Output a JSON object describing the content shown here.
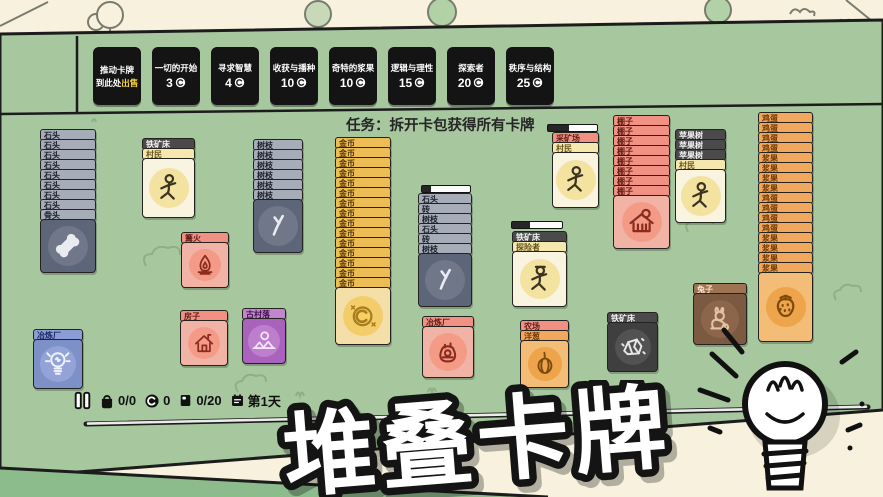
{
  "title_banner": {
    "text": "堆叠卡牌"
  },
  "task": {
    "label": "任务：拆开卡包获得所有卡牌"
  },
  "top_buttons": [
    {
      "line1": "推动卡牌",
      "line2_prefix": "到此处",
      "line2_highlight": "出售"
    },
    {
      "title": "一切的开始",
      "cost": "3"
    },
    {
      "title": "寻求智慧",
      "cost": "4"
    },
    {
      "title": "收获与播种",
      "cost": "10"
    },
    {
      "title": "奇特的浆果",
      "cost": "10"
    },
    {
      "title": "逻辑与理性",
      "cost": "15"
    },
    {
      "title": "探索者",
      "cost": "20"
    },
    {
      "title": "秩序与结构",
      "cost": "25"
    }
  ],
  "status_bar": {
    "pause_icon": "pause-icon",
    "bag_icon": "bag-icon",
    "bag_count": "0/0",
    "coin_icon": "coin-icon",
    "coin_count": "0",
    "card_icon": "cardpack-icon",
    "card_count": "0/20",
    "calendar_icon": "calendar-icon",
    "day_label": "第1天"
  },
  "colors": {
    "board_green": "#a7c79f",
    "paper_cream": "#f7f1dd",
    "button_black": "#141414",
    "sell_highlight": "#f6d335",
    "timeline_silver": "#ececec",
    "bottom_band_green": "#8cbc8c"
  },
  "board": {
    "stacks": [
      {
        "name": "stone-bone-stack",
        "x": 40,
        "y": 131,
        "w": 56,
        "bh": 54,
        "bars": [
          [
            "石头",
            "stone",
            8
          ],
          [
            "骨头",
            "stone",
            1
          ]
        ],
        "body": {
          "style": "stone",
          "icon": "bone-icon"
        }
      },
      {
        "name": "ironore-villager-stack",
        "x": 142,
        "y": 140,
        "w": 53,
        "bh": 60,
        "bars": [
          [
            "铁矿床",
            "dark",
            1
          ],
          [
            "村民",
            "cream",
            1
          ]
        ],
        "body": {
          "style": "cream",
          "icon": "villager-icon"
        }
      },
      {
        "name": "campfire-card",
        "x": 181,
        "y": 234,
        "w": 48,
        "bh": 46,
        "bars": [
          [
            "篝火",
            "salmon",
            1
          ]
        ],
        "body": {
          "style": "salmon",
          "icon": "flame-icon"
        }
      },
      {
        "name": "stick-stack",
        "x": 253,
        "y": 141,
        "w": 50,
        "bh": 54,
        "bars": [
          [
            "树枝",
            "stone",
            6
          ]
        ],
        "body": {
          "style": "stone",
          "icon": "stick-icon"
        }
      },
      {
        "name": "house-card",
        "x": 180,
        "y": 312,
        "w": 48,
        "bh": 46,
        "bars": [
          [
            "房子",
            "salmon",
            1
          ]
        ],
        "body": {
          "style": "salmon",
          "icon": "house-icon"
        }
      },
      {
        "name": "village-card",
        "x": 242,
        "y": 310,
        "w": 44,
        "bh": 46,
        "bars": [
          [
            "古村落",
            "purple",
            1
          ]
        ],
        "body": {
          "style": "purple",
          "icon": "village-icon"
        }
      },
      {
        "name": "coin-stack",
        "x": 335,
        "y": 139,
        "w": 56,
        "bh": 58,
        "bars": [
          [
            "金币",
            "gold",
            15
          ]
        ],
        "body": {
          "style": "gold",
          "icon": "coin-icon"
        }
      },
      {
        "name": "stone-brick-stick-stack",
        "x": 418,
        "y": 195,
        "w": 54,
        "bh": 54,
        "bars": [
          [
            "石头",
            "stone",
            1
          ],
          [
            "砖",
            "stone",
            1
          ],
          [
            "树枝",
            "stone",
            1
          ],
          [
            "石头",
            "stone",
            1
          ],
          [
            "砖",
            "stone",
            1
          ],
          [
            "树枝",
            "stone",
            1
          ]
        ],
        "body": {
          "style": "stone",
          "icon": "stick-icon"
        }
      },
      {
        "name": "smelter-card",
        "x": 422,
        "y": 318,
        "w": 52,
        "bh": 52,
        "bars": [
          [
            "冶炼厂",
            "salmon",
            1
          ]
        ],
        "body": {
          "style": "salmon",
          "icon": "furnace-icon"
        }
      },
      {
        "name": "ironore-explorer-stack",
        "x": 512,
        "y": 233,
        "w": 55,
        "bh": 56,
        "bars": [
          [
            "铁矿床",
            "dark",
            1
          ],
          [
            "探险者",
            "cream",
            1
          ]
        ],
        "body": {
          "style": "cream",
          "icon": "explorer-icon"
        }
      },
      {
        "name": "farm-onion-stack",
        "x": 520,
        "y": 322,
        "w": 49,
        "bh": 48,
        "bars": [
          [
            "农场",
            "salmon",
            1
          ],
          [
            "洋葱",
            "orange",
            1
          ]
        ],
        "body": {
          "style": "orange",
          "icon": "onion-icon"
        }
      },
      {
        "name": "idea-smelter-card",
        "x": 33,
        "y": 331,
        "w": 50,
        "bh": 50,
        "bars": [
          [
            "冶炼厂",
            "blue",
            1
          ]
        ],
        "body": {
          "style": "blue",
          "icon": "lightbulb-icon"
        }
      },
      {
        "name": "mine-villager-stack",
        "x": 552,
        "y": 134,
        "w": 47,
        "bh": 56,
        "bars": [
          [
            "采矿场",
            "salmon",
            1
          ],
          [
            "村民",
            "cream",
            1
          ]
        ],
        "body": {
          "style": "cream",
          "icon": "villager-icon"
        }
      },
      {
        "name": "shed-stack",
        "x": 613,
        "y": 117,
        "w": 57,
        "bh": 54,
        "bars": [
          [
            "棚子",
            "salmon",
            8
          ]
        ],
        "body": {
          "style": "salmon",
          "icon": "shed-icon"
        }
      },
      {
        "name": "appletree-villager-stack",
        "x": 675,
        "y": 131,
        "w": 51,
        "bh": 54,
        "bars": [
          [
            "苹果树",
            "dark",
            3
          ],
          [
            "村民",
            "cream",
            1
          ]
        ],
        "body": {
          "style": "cream",
          "icon": "villager-icon"
        }
      },
      {
        "name": "ironore-card",
        "x": 607,
        "y": 314,
        "w": 51,
        "bh": 50,
        "bars": [
          [
            "铁矿床",
            "dark",
            1
          ]
        ],
        "body": {
          "style": "dark",
          "icon": "ore-icon"
        }
      },
      {
        "name": "rabbit-card",
        "x": 693,
        "y": 285,
        "w": 54,
        "bh": 52,
        "bars": [
          [
            "兔子",
            "brown",
            1
          ]
        ],
        "body": {
          "style": "brown",
          "icon": "rabbit-icon"
        }
      },
      {
        "name": "egg-berry-stack",
        "x": 758,
        "y": 114,
        "w": 55,
        "bh": 70,
        "bars": [
          [
            "鸡蛋",
            "orange",
            4
          ],
          [
            "浆果",
            "orange",
            4
          ],
          [
            "鸡蛋",
            "orange",
            4
          ],
          [
            "浆果",
            "orange",
            4
          ]
        ],
        "body": {
          "style": "orange",
          "icon": "strawberry-icon"
        }
      }
    ],
    "timers": [
      {
        "x": 421,
        "y": 185,
        "w": 50,
        "pct": 18
      },
      {
        "x": 511,
        "y": 221,
        "w": 52,
        "pct": 35
      },
      {
        "x": 547,
        "y": 124,
        "w": 51,
        "pct": 42
      }
    ]
  }
}
